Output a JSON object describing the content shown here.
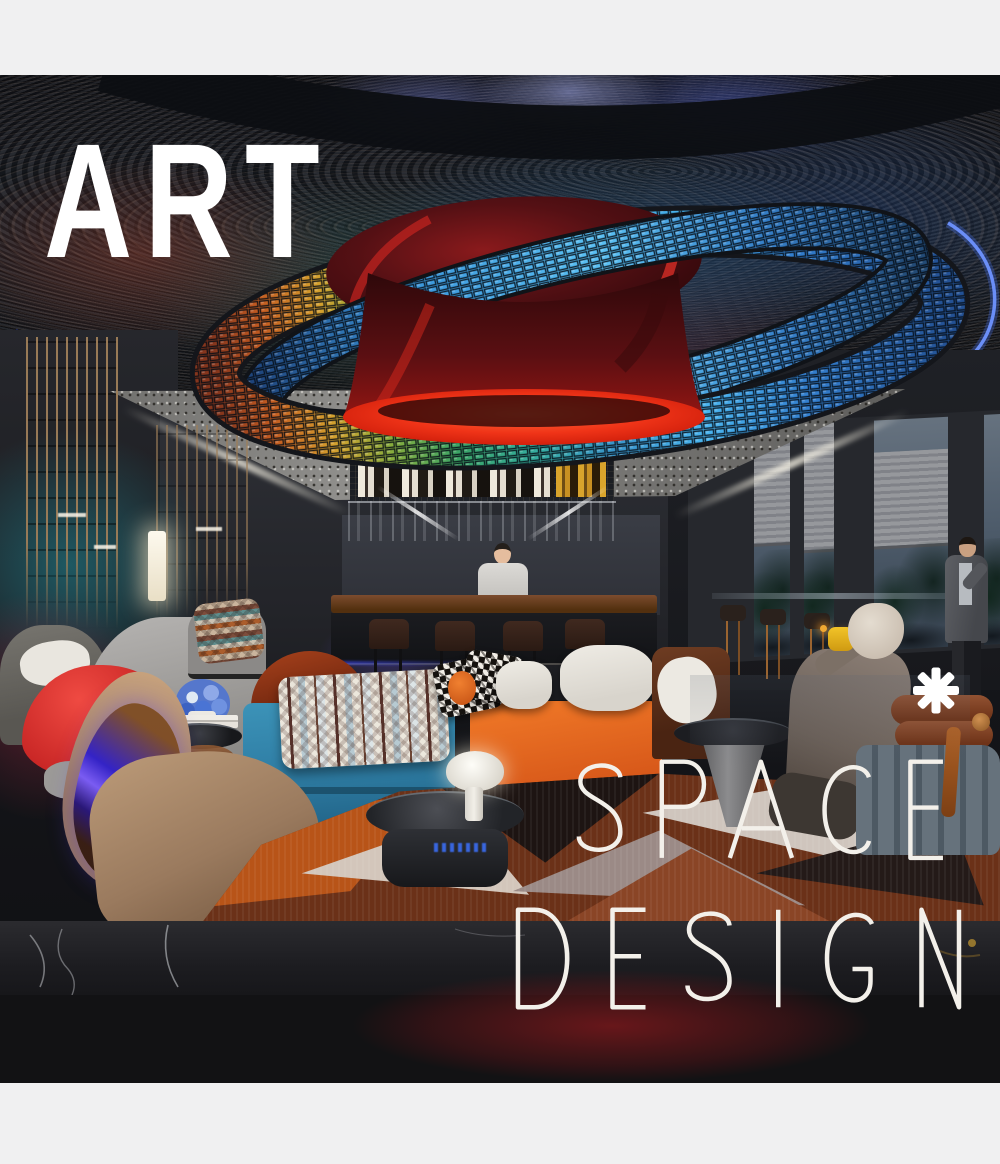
{
  "frame": {
    "background": "#f0f0f1"
  },
  "overlay": {
    "title": "ART",
    "space_label": "SPACE",
    "design_label": "DESIGN",
    "asterisk_icon": "asterisk-icon",
    "text_color": "#ffffff"
  },
  "scene": {
    "colors": {
      "frame-bg": "#f0f0f1",
      "overlay-text": "#ffffff",
      "neon-blue": "#4a6df4",
      "led-blue": "#38a4e8",
      "led-orange": "#d08a20",
      "lamp-red": "#e8321c",
      "disc-red": "#5a0e12",
      "sofa-blue": "#2f7ea5",
      "sofa-orange": "#d8591a",
      "chair-red": "#c22020",
      "chair-rust": "#6e250e",
      "chaise-tan": "#9a7a5e",
      "rug-rust": "#b85418",
      "glow-red": "#8a1518",
      "ceiling-grey": "#8f8e8b"
    }
  }
}
